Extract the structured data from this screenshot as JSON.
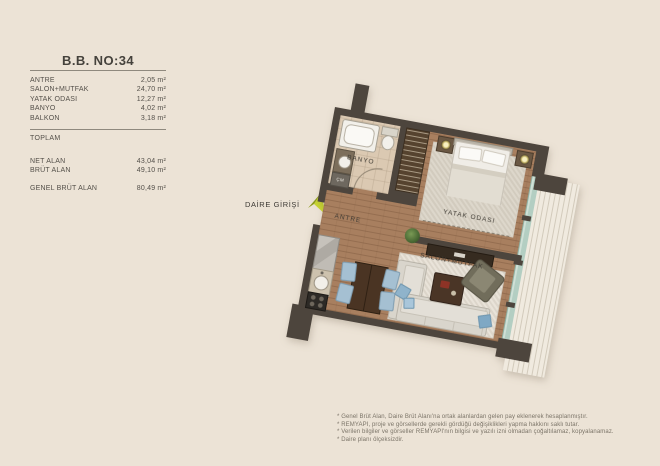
{
  "info_panel": {
    "title": "B.B. NO:34",
    "rooms": [
      {
        "label": "ANTRE",
        "value": "2,05 m²"
      },
      {
        "label": "SALON+MUTFAK",
        "value": "24,70 m²"
      },
      {
        "label": "YATAK ODASI",
        "value": "12,27 m²"
      },
      {
        "label": "BANYO",
        "value": "4,02 m²"
      },
      {
        "label": "BALKON",
        "value": "3,18 m²"
      }
    ],
    "subtotal_label": "TOPLAM",
    "totals": [
      {
        "label": "NET ALAN",
        "value": "43,04 m²"
      },
      {
        "label": "BRÜT ALAN",
        "value": "49,10 m²"
      }
    ],
    "general": {
      "label": "GENEL BRÜT ALAN",
      "value": "80,49 m²"
    }
  },
  "floor_plan": {
    "entrance_label": "DAİRE GİRİŞİ",
    "rooms": {
      "banyo": "BANYO",
      "antre": "ANTRE",
      "yatak_odasi": "YATAK ODASI",
      "salon_mutfak": "SALON+MUTFAK"
    },
    "washer_label": "ÇM",
    "colors": {
      "background": "#ece3d6",
      "wall": "#4d453d",
      "wood_floor": "#a87f5f",
      "bath_floor": "#dbc9b2",
      "glazing": "#b3cec2",
      "chair_blue": "#a5c0d2",
      "entrance_arrow": "#c9d631"
    }
  },
  "footnotes": [
    "* Genel Brüt Alan, Daire Brüt Alanı'na ortak alanlardan gelen pay eklenerek hesaplanmıştır.",
    "* REMYAPI, proje ve görsellerde gerekli gördüğü değişiklikleri yapma hakkını saklı tutar.",
    "* Verilen bilgiler ve görseller REMYAPI'nın bilgisi ve yazılı izni olmadan çoğaltılamaz, kopyalanamaz.",
    "* Daire planı ölçeksizdir."
  ]
}
